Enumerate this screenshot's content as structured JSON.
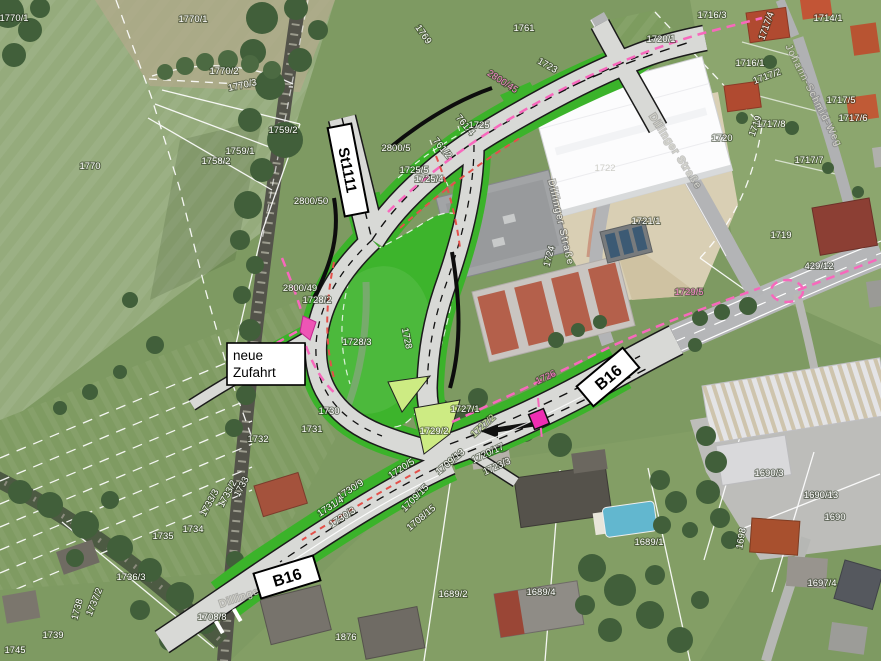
{
  "map": {
    "route_boxes": {
      "st1111": "St1111",
      "b16_east": "B16",
      "b16_south": "B16"
    },
    "note_box": {
      "line1": "neue",
      "line2": "Zufahrt"
    }
  },
  "street_names": [
    {
      "text": "Dillinger Straße",
      "x": 558,
      "y": 223,
      "rot": 77,
      "cls": "white-st"
    },
    {
      "text": "Dillinger Straße",
      "x": 673,
      "y": 153,
      "rot": 57,
      "cls": "gray-st"
    },
    {
      "text": "Dillinger Straße",
      "x": 262,
      "y": 593,
      "rot": -19,
      "cls": "gray-st"
    },
    {
      "text": "Johann-Schmid-Weg",
      "x": 811,
      "y": 97,
      "rot": 63,
      "cls": "gray-st"
    }
  ],
  "parcel_labels": [
    {
      "text": "1770/1",
      "x": 14,
      "y": 21
    },
    {
      "text": "1770/1",
      "x": 193,
      "y": 22
    },
    {
      "text": "1770/2",
      "x": 224,
      "y": 74
    },
    {
      "text": "1770/3",
      "x": 243,
      "y": 88,
      "rot": -12
    },
    {
      "text": "1759/2",
      "x": 283,
      "y": 133
    },
    {
      "text": "1759/1",
      "x": 240,
      "y": 154
    },
    {
      "text": "1758/2",
      "x": 216,
      "y": 164
    },
    {
      "text": "1770",
      "x": 90,
      "y": 169
    },
    {
      "text": "1769",
      "x": 421,
      "y": 36,
      "rot": 55
    },
    {
      "text": "1761",
      "x": 524,
      "y": 31
    },
    {
      "text": "2800/45",
      "x": 501,
      "y": 84,
      "rot": 33,
      "cls": "pink"
    },
    {
      "text": "1723",
      "x": 546,
      "y": 68,
      "rot": 30
    },
    {
      "text": "2800/5",
      "x": 396,
      "y": 151
    },
    {
      "text": "761/4",
      "x": 463,
      "y": 127,
      "rot": 50
    },
    {
      "text": "761/2",
      "x": 440,
      "y": 150,
      "rot": 50
    },
    {
      "text": "1725",
      "x": 479,
      "y": 128
    },
    {
      "text": "1725/5",
      "x": 414,
      "y": 173
    },
    {
      "text": "1725/4",
      "x": 429,
      "y": 182
    },
    {
      "text": "2800/50",
      "x": 311,
      "y": 204
    },
    {
      "text": "2800/49",
      "x": 300,
      "y": 291
    },
    {
      "text": "1728/2",
      "x": 317,
      "y": 303
    },
    {
      "text": "1728/3",
      "x": 357,
      "y": 345
    },
    {
      "text": "1728",
      "x": 404,
      "y": 339,
      "rot": 78
    },
    {
      "text": "1730",
      "x": 329,
      "y": 414
    },
    {
      "text": "1731",
      "x": 312,
      "y": 432
    },
    {
      "text": "1732",
      "x": 258,
      "y": 442
    },
    {
      "text": "1733",
      "x": 244,
      "y": 488,
      "rot": -62
    },
    {
      "text": "1733/2",
      "x": 230,
      "y": 495,
      "rot": -62
    },
    {
      "text": "1733/3",
      "x": 212,
      "y": 504,
      "rot": -62
    },
    {
      "text": "1734",
      "x": 193,
      "y": 532
    },
    {
      "text": "1735",
      "x": 163,
      "y": 539
    },
    {
      "text": "1736/3",
      "x": 131,
      "y": 580
    },
    {
      "text": "1737/2",
      "x": 97,
      "y": 603,
      "rot": -68
    },
    {
      "text": "1738",
      "x": 80,
      "y": 610,
      "rot": -75
    },
    {
      "text": "1739",
      "x": 53,
      "y": 638
    },
    {
      "text": "1745",
      "x": 15,
      "y": 653
    },
    {
      "text": "1708/8",
      "x": 212,
      "y": 620
    },
    {
      "text": "1730/9",
      "x": 352,
      "y": 492,
      "rot": -33
    },
    {
      "text": "1731/4",
      "x": 332,
      "y": 509,
      "rot": -33
    },
    {
      "text": "1730/3",
      "x": 344,
      "y": 520,
      "rot": -33
    },
    {
      "text": "1709/15",
      "x": 417,
      "y": 500,
      "rot": -45
    },
    {
      "text": "1708/15",
      "x": 423,
      "y": 520,
      "rot": -40
    },
    {
      "text": "1720/5",
      "x": 403,
      "y": 471,
      "rot": -33
    },
    {
      "text": "1709/13",
      "x": 452,
      "y": 464,
      "rot": -40
    },
    {
      "text": "1720/17",
      "x": 489,
      "y": 456,
      "rot": -25
    },
    {
      "text": "1723/3",
      "x": 498,
      "y": 469,
      "rot": -25
    },
    {
      "text": "1727/1",
      "x": 465,
      "y": 412
    },
    {
      "text": "1727/2",
      "x": 485,
      "y": 428,
      "rot": -42,
      "cls": "green-lbl"
    },
    {
      "text": "1729/2",
      "x": 434,
      "y": 434
    },
    {
      "text": "1726",
      "x": 547,
      "y": 380,
      "rot": -25,
      "cls": "pink"
    },
    {
      "text": "1876",
      "x": 346,
      "y": 640
    },
    {
      "text": "1689/2",
      "x": 453,
      "y": 597
    },
    {
      "text": "1689/4",
      "x": 541,
      "y": 595
    },
    {
      "text": "1689/1",
      "x": 649,
      "y": 545
    },
    {
      "text": "1690/3",
      "x": 769,
      "y": 476
    },
    {
      "text": "1690/13",
      "x": 821,
      "y": 498
    },
    {
      "text": "1690",
      "x": 835,
      "y": 520
    },
    {
      "text": "1697/4",
      "x": 822,
      "y": 586
    },
    {
      "text": "1698",
      "x": 744,
      "y": 539,
      "rot": -80
    },
    {
      "text": "1729/5",
      "x": 689,
      "y": 295,
      "cls": "pink"
    },
    {
      "text": "429/12",
      "x": 819,
      "y": 269
    },
    {
      "text": "1719",
      "x": 781,
      "y": 238
    },
    {
      "text": "1719",
      "x": 758,
      "y": 127,
      "rot": -70
    },
    {
      "text": "1720",
      "x": 722,
      "y": 141
    },
    {
      "text": "1720/1",
      "x": 661,
      "y": 42
    },
    {
      "text": "1716/3",
      "x": 712,
      "y": 18
    },
    {
      "text": "1717/4",
      "x": 769,
      "y": 27,
      "rot": -70
    },
    {
      "text": "1714/1",
      "x": 828,
      "y": 21
    },
    {
      "text": "1716/1",
      "x": 750,
      "y": 66
    },
    {
      "text": "1717/2",
      "x": 768,
      "y": 79,
      "rot": -20
    },
    {
      "text": "1717/5",
      "x": 841,
      "y": 103
    },
    {
      "text": "1717/6",
      "x": 853,
      "y": 121
    },
    {
      "text": "1717/8",
      "x": 771,
      "y": 127
    },
    {
      "text": "1717/7",
      "x": 809,
      "y": 163
    },
    {
      "text": "1721/1",
      "x": 646,
      "y": 224
    },
    {
      "text": "1722",
      "x": 605,
      "y": 171,
      "cls": "faint"
    },
    {
      "text": "1724",
      "x": 552,
      "y": 257,
      "rot": -75
    }
  ],
  "legend_colors": {
    "overlay_green": "#3bb32a",
    "island_green": "#cdeb83",
    "magenta_crossing": "#ee2eb2",
    "pink_boundary": "#f768bc",
    "demolition_red": "#e4504a",
    "plan_road": "#d8d9d6",
    "aerial_road": "#b5b6b8"
  }
}
